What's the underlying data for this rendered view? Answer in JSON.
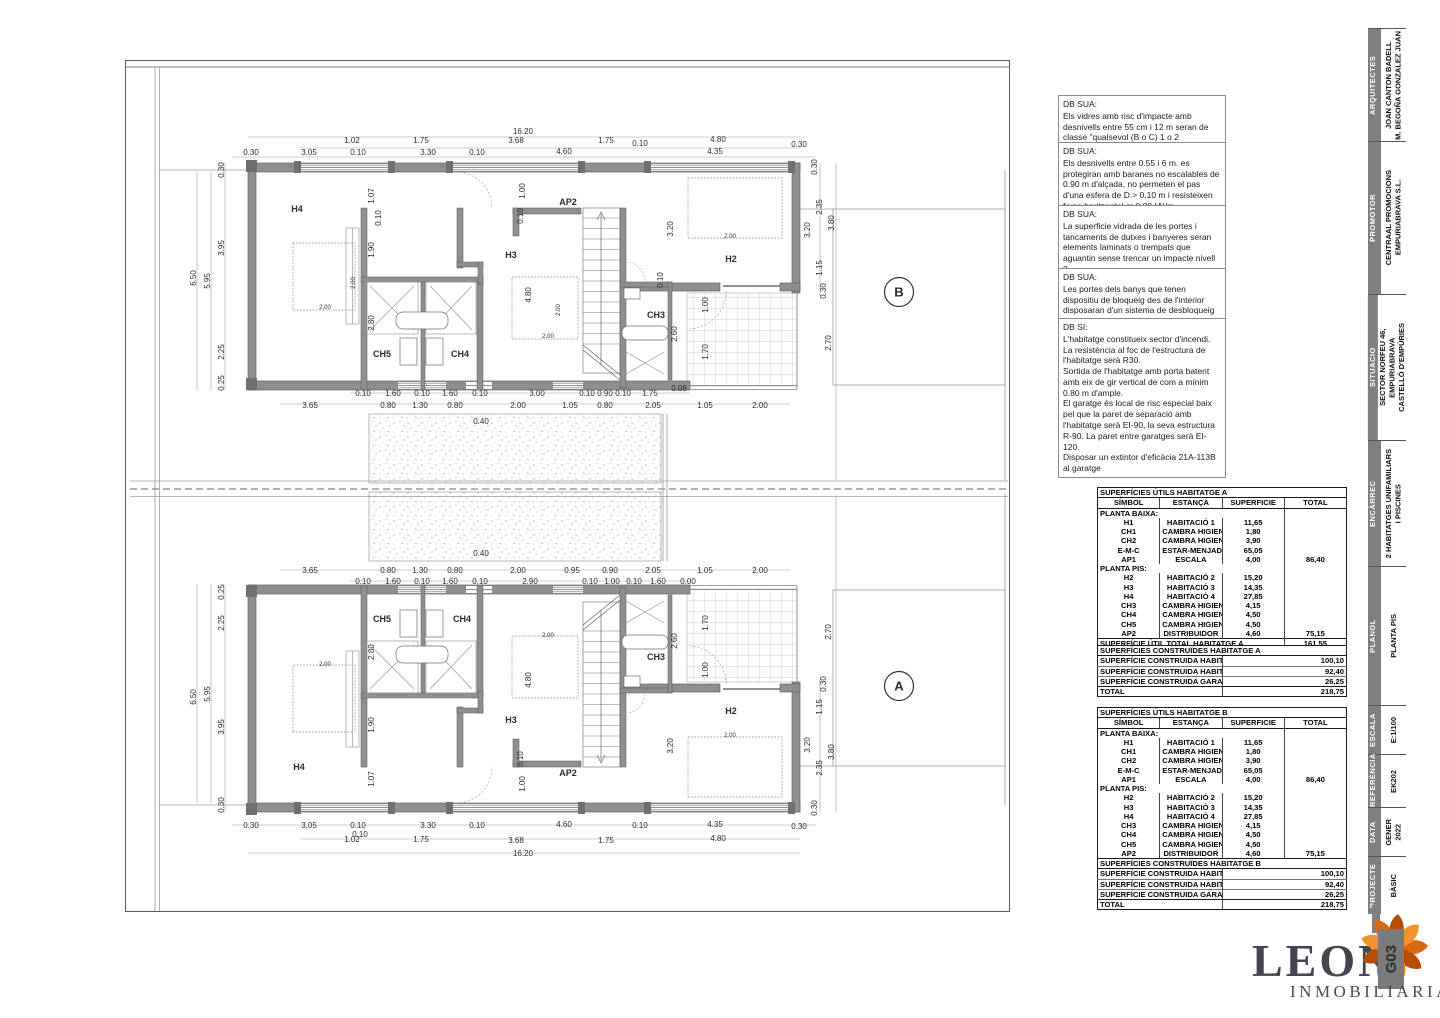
{
  "notes": [
    {
      "title": "DB SUA:",
      "body": "Els vidres amb risc d'impacte amb desnivells entre 55 cm i 12 m seran de classe \"qualsevol (B o C) 1 o 2"
    },
    {
      "title": "DB SUA:",
      "body": "Els desnivells entre 0.55 i 6 m. es protegiran amb baranes no escalables de 0.90 m d'alçada, no permeten el pas d'una esfera de D.> 0.10 m i resisteixen força horitzontal q>0.80 kN/m"
    },
    {
      "title": "DB SUA:",
      "body": "La superficie vidrada de les portes i tancaments de dutxes i banyeres seran elements laminats o trempats que aguantin sense trencar un impacte nivell 3"
    },
    {
      "title": "DB SUA:",
      "body": "Les portes dels banys que tenen dispositiu de bloqueig des de l'interior disposaran d'un sistema de desbloqueig des de l'exterior"
    },
    {
      "title": "DB SI:",
      "body": "L'habitatge constitueix sector d'incendi.\nLa resistència al foc de l'estructura de l'habitatge serà R30.\nSortida de l'habitatge amb porta batent amb eix de gir vertical de com a mínim 0.80 m d'ample.\nEl garatge és local de risc especial baix pel que la paret de separació amb l'habitatge serà EI-90, la seva estructura R-90. La paret entre garatges serà EI-120.\nDisposar un extintor d'eficàcia 21A-113B al garatge"
    }
  ],
  "tables": {
    "utils_a": {
      "title": "SUPERFÍCIES ÚTILS HABITATGE A",
      "headers": [
        "SÍMBOL",
        "ESTANÇA",
        "SUPERFICIE",
        "TOTAL"
      ],
      "sections": [
        {
          "name": "PLANTA BAIXA:",
          "rows": [
            [
              "H1",
              "HABITACIÓ 1",
              "11,65",
              ""
            ],
            [
              "CH1",
              "CAMBRA HIGIENICA 1",
              "1,80",
              ""
            ],
            [
              "CH2",
              "CAMBRA HIGIENICA 2",
              "3,90",
              ""
            ],
            [
              "E-M-C",
              "ESTAR-MENJADOR-CUINA",
              "65,05",
              ""
            ],
            [
              "AP1",
              "ESCALA",
              "4,00",
              "86,40"
            ]
          ]
        },
        {
          "name": "PLANTA PIS:",
          "rows": [
            [
              "H2",
              "HABITACIÓ 2",
              "15,20",
              ""
            ],
            [
              "H3",
              "HABITACIÓ 3",
              "14,35",
              ""
            ],
            [
              "H4",
              "HABITACIÓ 4",
              "27,85",
              ""
            ],
            [
              "CH3",
              "CAMBRA HIGIENICA 3",
              "4,15",
              ""
            ],
            [
              "CH4",
              "CAMBRA HIGIENICA 4",
              "4,50",
              ""
            ],
            [
              "CH5",
              "CAMBRA HIGIENICA 5",
              "4,50",
              ""
            ],
            [
              "AP2",
              "DISTRIBUIDOR",
              "4,60",
              "75,15"
            ]
          ]
        }
      ],
      "footer": [
        "SUPERFÍCIE ÚTIL TOTAL HABITATGE A",
        "161,55"
      ]
    },
    "utils_b": {
      "title": "SUPERFÍCIES ÚTILS HABITATGE B",
      "headers": [
        "SÍMBOL",
        "ESTANÇA",
        "SUPERFICIE",
        "TOTAL"
      ],
      "sections": [
        {
          "name": "PLANTA BAIXA:",
          "rows": [
            [
              "H1",
              "HABITACIÓ 1",
              "11,65",
              ""
            ],
            [
              "CH1",
              "CAMBRA HIGIENICA 1",
              "1,80",
              ""
            ],
            [
              "CH2",
              "CAMBRA HIGIENICA 2",
              "3,90",
              ""
            ],
            [
              "E-M-C",
              "ESTAR-MENJADOR-CUINA",
              "65,05",
              ""
            ],
            [
              "AP1",
              "ESCALA",
              "4,00",
              "86,40"
            ]
          ]
        },
        {
          "name": "PLANTA PIS:",
          "rows": [
            [
              "H2",
              "HABITACIÓ 2",
              "15,20",
              ""
            ],
            [
              "H3",
              "HABITACIÓ 3",
              "14,35",
              ""
            ],
            [
              "H4",
              "HABITACIÓ 4",
              "27,85",
              ""
            ],
            [
              "CH3",
              "CAMBRA HIGIENICA 3",
              "4,15",
              ""
            ],
            [
              "CH4",
              "CAMBRA HIGIENICA 4",
              "4,50",
              ""
            ],
            [
              "CH5",
              "CAMBRA HIGIENICA 5",
              "4,50",
              ""
            ],
            [
              "AP2",
              "DISTRIBUIDOR",
              "4,60",
              "75,15"
            ]
          ]
        }
      ],
      "footer": [
        "SUPERFÍCIE ÚTIL TOTAL HABITATGE B",
        "161,55"
      ]
    },
    "built_a": {
      "title": "SUPERFÍCIES CONSTRUÏDES HABITATGE A",
      "rows": [
        [
          "SUPERFÍCIE CONSTRUIDA HABITATGE A PLANTA BAIXA",
          "100,10"
        ],
        [
          "SUPERFÍCIE CONSTRUIDA HABITATGE A PLANTA PRIMERA",
          "92,40"
        ],
        [
          "SUPERFÍCIE CONSTRUIDA GARATGE",
          "26,25"
        ]
      ],
      "total": [
        "TOTAL",
        "218,75"
      ]
    },
    "built_b": {
      "title": "SUPERFÍCIES CONSTRUÏDES HABITATGE B",
      "rows": [
        [
          "SUPERFÍCIE CONSTRUIDA HABITATGE A PLANTA BAIXA",
          "100,10"
        ],
        [
          "SUPERFÍCIE CONSTRUIDA HABITATGE A PLANTA PRIMERA",
          "92,40"
        ],
        [
          "SUPERFÍCIE CONSTRUIDA GARATGE",
          "26,25"
        ]
      ],
      "total": [
        "TOTAL",
        "218,75"
      ]
    }
  },
  "titleblock": {
    "sections": [
      {
        "label": "ARQUITECTES",
        "value": "JOAN CANTON BADELL\nM. BEGOÑA GONZALEZ JUAN"
      },
      {
        "label": "PROMOTOR",
        "value": "CENTRAAL PROMOCIONS\nEMPURIABRAVA S.L."
      },
      {
        "label": "SITUACIO",
        "value": "SECTOR NORFEU 46,\nEMPURIABRAVA\nCASTELLÓ D'EMPÚRIES"
      },
      {
        "label": "ENCÀRREC",
        "value": "2 HABITATGES UNIFAMILIARS\nI PISCINES"
      },
      {
        "label": "PLANOL",
        "value": "PLANTA PIS"
      },
      {
        "label": "ESCALA",
        "value": "E:1/100"
      },
      {
        "label": "REFERÈNCIA",
        "value": "EK202"
      },
      {
        "label": "DATA",
        "value": "GENER\n2022"
      },
      {
        "label": "PROJECTE",
        "value": "BÀSIC"
      }
    ],
    "sheet_number": "G03"
  },
  "logo": {
    "name": "LEON",
    "sub": "INMOBILIARIA"
  },
  "plans": {
    "b": {
      "marker": "B",
      "marker_x": 899,
      "marker_y": 292,
      "rooms": [
        [
          297,
          212,
          "H4"
        ],
        [
          568,
          205,
          "AP2"
        ],
        [
          511,
          258,
          "H3"
        ],
        [
          731,
          262,
          "H2"
        ],
        [
          382,
          357,
          "CH5"
        ],
        [
          460,
          357,
          "CH4"
        ],
        [
          656,
          318,
          "CH3"
        ]
      ],
      "dims": [
        [
          523,
          134,
          "16.20"
        ],
        [
          352,
          143,
          "1.02"
        ],
        [
          421,
          143,
          "1.75"
        ],
        [
          516,
          143,
          "3.68"
        ],
        [
          606,
          143,
          "1.75"
        ],
        [
          640,
          146,
          "0.10"
        ],
        [
          718,
          142,
          "4.80"
        ],
        [
          251,
          155,
          "0.30"
        ],
        [
          309,
          155,
          "3.05"
        ],
        [
          358,
          155,
          "0.10"
        ],
        [
          428,
          155,
          "3.30"
        ],
        [
          477,
          155,
          "0.10"
        ],
        [
          564,
          154,
          "4.60"
        ],
        [
          715,
          154,
          "4.35"
        ],
        [
          799,
          147,
          "0.30"
        ],
        [
          224,
          170,
          "0.30",
          1
        ],
        [
          224,
          248,
          "3.95",
          1
        ],
        [
          196,
          278,
          "6.50",
          1
        ],
        [
          210,
          281,
          "5.95",
          1
        ],
        [
          224,
          352,
          "2.25",
          1
        ],
        [
          224,
          383,
          "0.25",
          1
        ],
        [
          817,
          167,
          "0.30",
          1
        ],
        [
          822,
          207,
          "2.35",
          1
        ],
        [
          834,
          223,
          "3.80",
          1
        ],
        [
          810,
          230,
          "3.20",
          1
        ],
        [
          822,
          268,
          "1.15",
          1
        ],
        [
          826,
          291,
          "0.30",
          1
        ],
        [
          831,
          343,
          "2.70",
          1
        ],
        [
          374,
          196,
          "1.07",
          1
        ],
        [
          374,
          250,
          "1.90",
          1
        ],
        [
          381,
          218,
          "0.10",
          1
        ],
        [
          374,
          323,
          "2.80",
          1
        ],
        [
          531,
          295,
          "4.80",
          1
        ],
        [
          525,
          191,
          "1.00",
          1
        ],
        [
          523,
          216,
          "0.10",
          1
        ],
        [
          673,
          229,
          "3.20",
          1
        ],
        [
          663,
          280,
          "0.10",
          1
        ],
        [
          677,
          334,
          "2.60",
          1
        ],
        [
          708,
          305,
          "1.00",
          1
        ],
        [
          708,
          352,
          "1.70",
          1
        ],
        [
          325,
          309,
          "2.00",
          0,
          6
        ],
        [
          355,
          283,
          "2.00",
          1,
          6
        ],
        [
          548,
          338,
          "2.00",
          0,
          6
        ],
        [
          560,
          310,
          "2.00",
          1,
          6
        ],
        [
          730,
          238,
          "2.00",
          0,
          6
        ],
        [
          363,
          396,
          "0.10"
        ],
        [
          393,
          396,
          "1.60"
        ],
        [
          422,
          396,
          "0.10"
        ],
        [
          450,
          396,
          "1.60"
        ],
        [
          480,
          396,
          "0.10"
        ],
        [
          537,
          396,
          "3.00"
        ],
        [
          587,
          396,
          "0.10"
        ],
        [
          605,
          396,
          "0.90"
        ],
        [
          623,
          396,
          "0.10"
        ],
        [
          650,
          396,
          "1.75"
        ],
        [
          679,
          391,
          "0.08"
        ],
        [
          310,
          408,
          "3.65"
        ],
        [
          388,
          408,
          "0.80"
        ],
        [
          420,
          408,
          "1.30"
        ],
        [
          455,
          408,
          "0.80"
        ],
        [
          518,
          408,
          "2.00"
        ],
        [
          570,
          408,
          "1.05"
        ],
        [
          605,
          408,
          "0.80"
        ],
        [
          653,
          408,
          "2.05"
        ],
        [
          705,
          408,
          "1.05"
        ],
        [
          760,
          408,
          "2.00"
        ],
        [
          481,
          424,
          "0.40"
        ]
      ]
    },
    "a": {
      "marker": "A",
      "marker_x": 899,
      "marker_y": 686,
      "rooms": [
        [
          299,
          770,
          "H4"
        ],
        [
          382,
          622,
          "CH5"
        ],
        [
          462,
          622,
          "CH4"
        ],
        [
          511,
          723,
          "H3"
        ],
        [
          568,
          776,
          "AP2"
        ],
        [
          656,
          660,
          "CH3"
        ],
        [
          731,
          714,
          "H2"
        ]
      ],
      "dims": [
        [
          310,
          573,
          "3.65"
        ],
        [
          388,
          573,
          "0.80"
        ],
        [
          420,
          573,
          "1.30"
        ],
        [
          455,
          573,
          "0.80"
        ],
        [
          518,
          573,
          "2.00"
        ],
        [
          572,
          573,
          "0.95"
        ],
        [
          610,
          573,
          "0.90"
        ],
        [
          653,
          573,
          "2.05"
        ],
        [
          705,
          573,
          "1.05"
        ],
        [
          760,
          573,
          "2.00"
        ],
        [
          363,
          584,
          "0.10"
        ],
        [
          393,
          584,
          "1.60"
        ],
        [
          422,
          584,
          "0.10"
        ],
        [
          450,
          584,
          "1.60"
        ],
        [
          480,
          584,
          "0.10"
        ],
        [
          530,
          584,
          "2.90"
        ],
        [
          590,
          584,
          "0.10"
        ],
        [
          612,
          584,
          "1.00"
        ],
        [
          634,
          584,
          "0.10"
        ],
        [
          658,
          584,
          "1.60"
        ],
        [
          688,
          584,
          "0.00"
        ],
        [
          481,
          556,
          "0.40"
        ],
        [
          224,
          805,
          "0.30",
          1
        ],
        [
          224,
          727,
          "3.95",
          1
        ],
        [
          196,
          697,
          "6.50",
          1
        ],
        [
          210,
          694,
          "5.95",
          1
        ],
        [
          224,
          623,
          "2.25",
          1
        ],
        [
          224,
          592,
          "0.25",
          1
        ],
        [
          817,
          808,
          "0.30",
          1
        ],
        [
          822,
          768,
          "2.35",
          1
        ],
        [
          834,
          752,
          "3.80",
          1
        ],
        [
          810,
          745,
          "3.20",
          1
        ],
        [
          822,
          707,
          "1.15",
          1
        ],
        [
          826,
          684,
          "0.30",
          1
        ],
        [
          831,
          632,
          "2.70",
          1
        ],
        [
          374,
          779,
          "1.07",
          1
        ],
        [
          374,
          725,
          "1.90",
          1
        ],
        [
          374,
          652,
          "2.80",
          1
        ],
        [
          531,
          680,
          "4.80",
          1
        ],
        [
          525,
          784,
          "1.00",
          1
        ],
        [
          523,
          759,
          "0.10",
          1
        ],
        [
          673,
          746,
          "3.20",
          1
        ],
        [
          677,
          641,
          "2.60",
          1
        ],
        [
          708,
          670,
          "1.00",
          1
        ],
        [
          708,
          623,
          "1.70",
          1
        ],
        [
          325,
          666,
          "2.00",
          0,
          6
        ],
        [
          548,
          637,
          "2.00",
          0,
          6
        ],
        [
          730,
          737,
          "2.00",
          0,
          6
        ],
        [
          251,
          828,
          "0.30"
        ],
        [
          309,
          828,
          "3.05"
        ],
        [
          358,
          828,
          "0.10"
        ],
        [
          428,
          828,
          "3.30"
        ],
        [
          477,
          828,
          "0.10"
        ],
        [
          564,
          827,
          "4.60"
        ],
        [
          640,
          828,
          "0.10"
        ],
        [
          715,
          827,
          "4.35"
        ],
        [
          799,
          829,
          "0.30"
        ],
        [
          352,
          842,
          "1.02"
        ],
        [
          360,
          837,
          "0.10"
        ],
        [
          421,
          842,
          "1.75"
        ],
        [
          516,
          843,
          "3.68"
        ],
        [
          606,
          843,
          "1.75"
        ],
        [
          718,
          841,
          "4.80"
        ],
        [
          523,
          856,
          "16.20"
        ]
      ]
    }
  }
}
